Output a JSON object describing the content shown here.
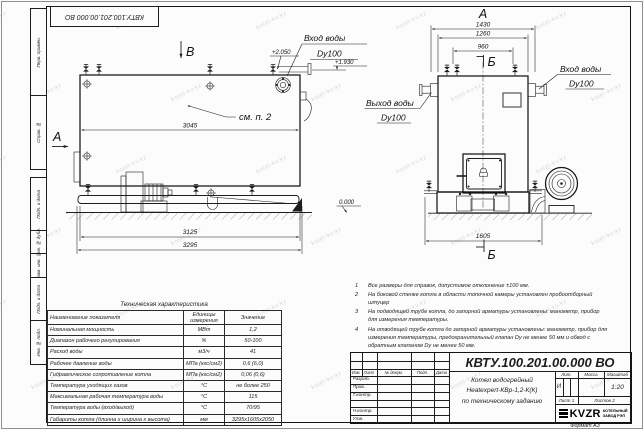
{
  "stamp": "КВТУ.100.201.00.000 ВО",
  "watermark": {
    "text": "kotel-kv.kz"
  },
  "sidebar": {
    "labels": [
      "Перв. примен.",
      "Справ. №",
      "Подп. и дата",
      "Инв. № дубл.",
      "Взам. инв. №",
      "Подп. и дата",
      "Инв. № подл."
    ]
  },
  "drawing": {
    "view_a": "А",
    "view_b": "В",
    "section_b": "Б",
    "see_note": "см. п. 2",
    "d3045": "3045",
    "d3125": "3125",
    "d3295": "3295",
    "d1430": "1430",
    "d1260": "1260",
    "d960": "960",
    "d1605": "1605",
    "level_2050": "+2.050",
    "level_1930": "+1.930",
    "level_zero": "0.000",
    "inlet_label": "Вход воды",
    "outlet_label": "Выход воды",
    "dy100": "Dy100"
  },
  "notes": [
    {
      "num": "1",
      "text": "Все размеры для справок, допустимое отклонение ±100 мм."
    },
    {
      "num": "2",
      "text": "На боковой стенке котла в области топочной камеры установлен пробоотборный штуцер"
    },
    {
      "num": "3",
      "text": "На подводящей трубе котла, до запорной арматуры установлены: манометр, прибор для измерения температуры."
    },
    {
      "num": "4",
      "text": "На отводящей трубе котла до запорной арматуры установлены: манометр, прибор для измерения температуры, предохранительный клапан Dу не менее 50 мм и обвод с обратным клапаном Dу не менее 50 мм."
    }
  ],
  "tech_table": {
    "title": "Техническая характеристика",
    "headers": [
      "Наименование показателя",
      "Единицы измерения",
      "Значение"
    ],
    "rows": [
      [
        "Номинальная мощность",
        "МВт",
        "1,2"
      ],
      [
        "Диапазон рабочего регулирования",
        "%",
        "50-100"
      ],
      [
        "Расход воды",
        "м3/ч",
        "41"
      ],
      [
        "Рабочее давление воды",
        "МПа (кгс/см2)",
        "0,6 (6,0)"
      ],
      [
        "Гидравлическое сопротивление котла",
        "МПа (кгс/см2)",
        "0,06 (0,6)"
      ],
      [
        "Температура уходящих газов",
        "°С",
        "не более 250"
      ],
      [
        "Максимальная рабочая температура воды",
        "°С",
        "115"
      ],
      [
        "Температура воды (вход/выход)",
        "°С",
        "70/95"
      ],
      [
        "Габариты котла (длинна х ширина х высота)",
        "мм",
        "3295х1605х2050"
      ]
    ]
  },
  "title_block": {
    "doc_number": "КВТУ.100.201.00.000  ВО",
    "rev_headers": [
      "Изм.",
      "Лист",
      "№ докум.",
      "Подп.",
      "Дата"
    ],
    "sign_labels": [
      "Разраб.",
      "Пров.",
      "Т.контр.",
      "",
      "Н.контр.",
      "Утв."
    ],
    "description": [
      "Котел водогрейный",
      "Heatexpert-КВр-1,2-К(К)",
      "по техническому заданию"
    ],
    "lit_header": "Лит.",
    "mass_header": "Масса",
    "scale_header": "Масштаб",
    "lit_value": "И",
    "scale_value": "1:20",
    "sheet_cell": "Лист 1",
    "sheets_cell": "Листов 2",
    "logo_text": "KVZR",
    "logo_lines": [
      "КОТЕЛЬНЫЙ",
      "ЗАВОД РЭП"
    ],
    "format_label": "Формат А3"
  }
}
